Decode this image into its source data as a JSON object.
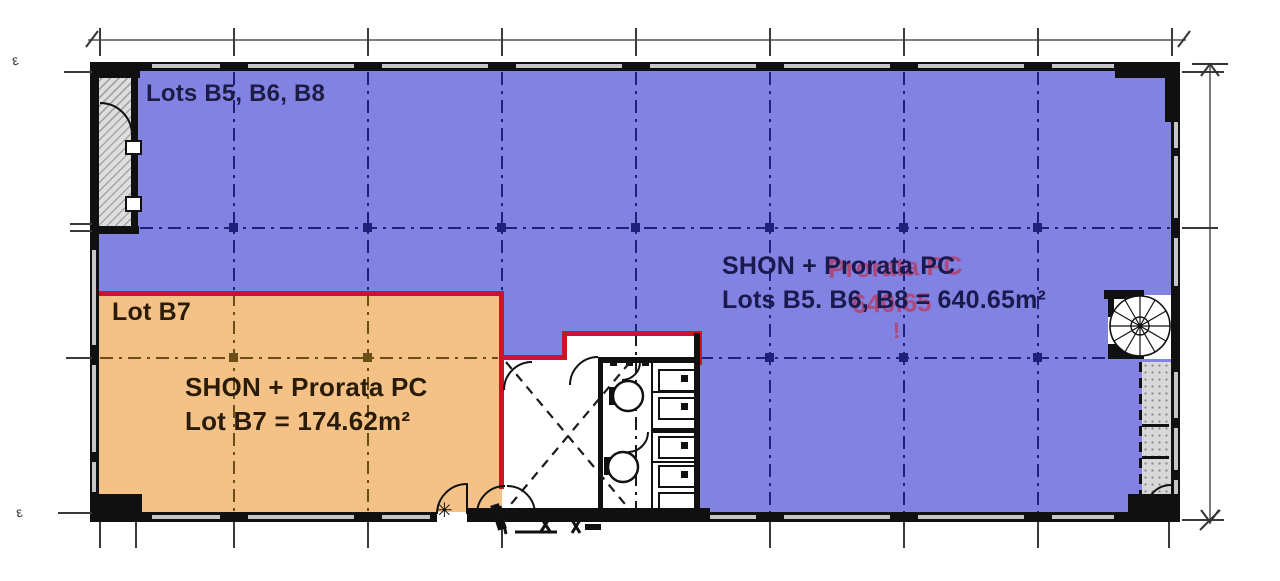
{
  "colors": {
    "zone_blue": "#8182e2",
    "zone_orange": "#f4c287",
    "lot_boundary_red": "#cd1422",
    "text_navy": "#1c1c44",
    "text_brown": "#2a1c08",
    "grid_navy": "#20207a",
    "grid_brown": "#6b4f17",
    "wall_black": "#101010"
  },
  "zones": {
    "blue": {
      "name_label": "Lots B5, B6, B8",
      "area_line1": "SHON + Prorata PC",
      "area_line2": "Lots B5. B6, B8 = 640.65m²"
    },
    "orange": {
      "name_label": "Lot B7",
      "area_line1": "SHON + Prorata PC",
      "area_line2": "Lot B7 = 174.62m²"
    }
  },
  "annotations": {
    "red_ghost_line1": "Prorata PC",
    "red_ghost_line2": "640.65",
    "red_ghost_mark": "!"
  },
  "icons": {
    "star_marker": "✳",
    "datum_mark_top": "ε",
    "datum_mark_bottom": "ε"
  }
}
